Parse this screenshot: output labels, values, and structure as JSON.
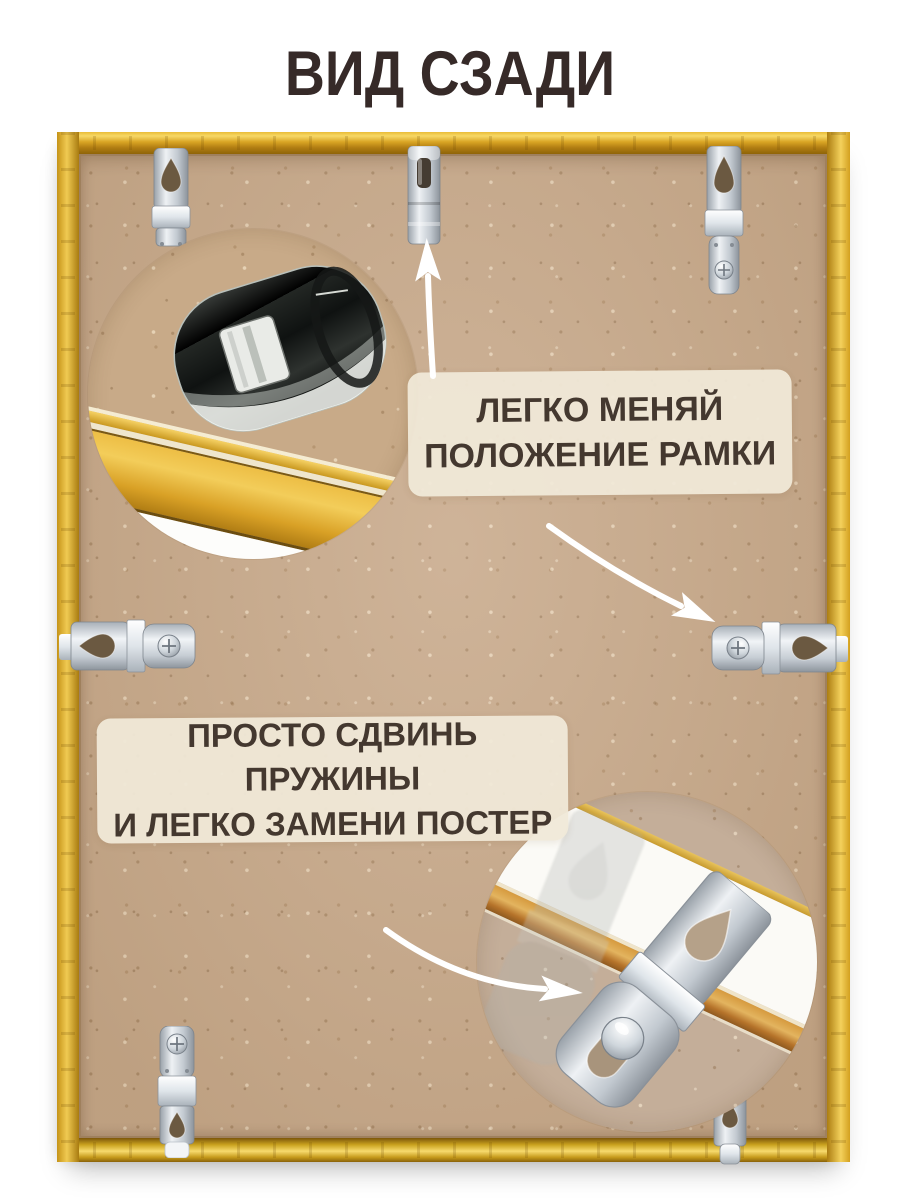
{
  "title": "ВИД СЗАДИ",
  "callouts": {
    "position": {
      "line1": "ЛЕГКО МЕНЯЙ",
      "line2": "ПОЛОЖЕНИЕ РАМКИ"
    },
    "replace": {
      "line1": "ПРОСТО СДВИНЬ ПРУЖИНЫ",
      "line2": "И ЛЕГКО ЗАМЕНИ ПОСТЕР"
    }
  },
  "icons": {
    "arrow_up": "↑",
    "arrow_down_right": "↘",
    "arrow_right": "→"
  },
  "colors": {
    "page_bg": "#ffffff",
    "title_text": "#362a28",
    "frame_gold": "#e0a92c",
    "backing_mdf": "#c9ab8d",
    "callout_bg": "#f0e9d8",
    "callout_text": "#44382f",
    "metal_clip": "#ccd2d8",
    "spring_chrome": "#1d211f",
    "arrow": "#ffffff"
  }
}
